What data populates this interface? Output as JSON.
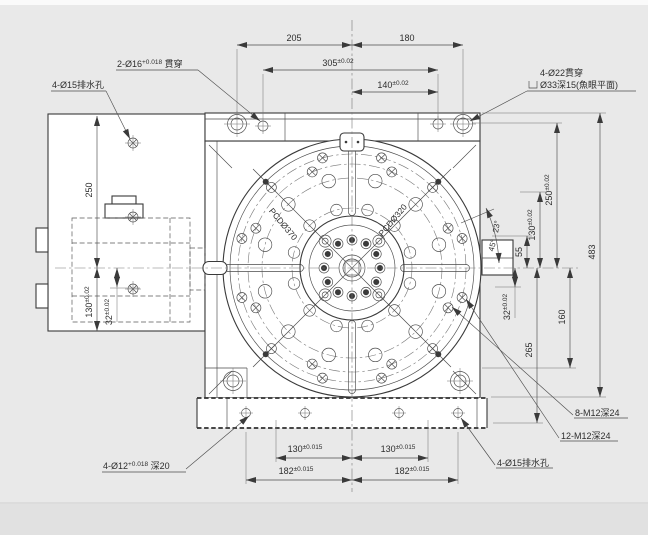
{
  "colors": {
    "background": "#e9e9e9",
    "line": "#3a3a3a",
    "dim_line": "#4d4d4d",
    "face": "#ffffff"
  },
  "notes": {
    "drain_top": "4-Ø15排水孔",
    "pin": {
      "main": "2-Ø16",
      "tol": "+0.018",
      "suffix": " 貫穿"
    },
    "cbore_line1": "4-Ø22貫穿",
    "cbore_line2": "Ø33深15(魚眼平面)",
    "m12_8": "8-M12深24",
    "m12_12": "12-M12深24",
    "dowel": {
      "main": "4-Ø12",
      "tol": "+0.018",
      "suffix": " 深20"
    },
    "drain_bottom": "4-Ø15排水孔",
    "pcd370": "PCDØ370",
    "pcd320": "PCDØ320"
  },
  "dims": {
    "top_left": "205",
    "top_right": "180",
    "w305": {
      "v": "305",
      "tol": "±0.02"
    },
    "w140": {
      "v": "140",
      "tol": "±0.02"
    },
    "right": {
      "h483": "483",
      "h250": {
        "v": "250",
        "tol": "±0.02"
      },
      "h130": {
        "v": "130",
        "tol": "±0.02"
      },
      "h55": "55",
      "h32": {
        "v": "32",
        "tol": "±0.02"
      },
      "h160": "160",
      "h265": "265"
    },
    "left": {
      "h250": "250",
      "h130": {
        "v": "130",
        "tol": "±0.02"
      },
      "h32": {
        "v": "32",
        "tol": "±0.02"
      }
    },
    "bottom": {
      "b130l": {
        "v": "130",
        "tol": "±0.015"
      },
      "b130r": {
        "v": "130",
        "tol": "±0.015"
      },
      "b182l": {
        "v": "182",
        "tol": "±0.015"
      },
      "b182r": {
        "v": "182",
        "tol": "±0.015"
      }
    },
    "angle1": "23°",
    "angle2": "45°"
  }
}
